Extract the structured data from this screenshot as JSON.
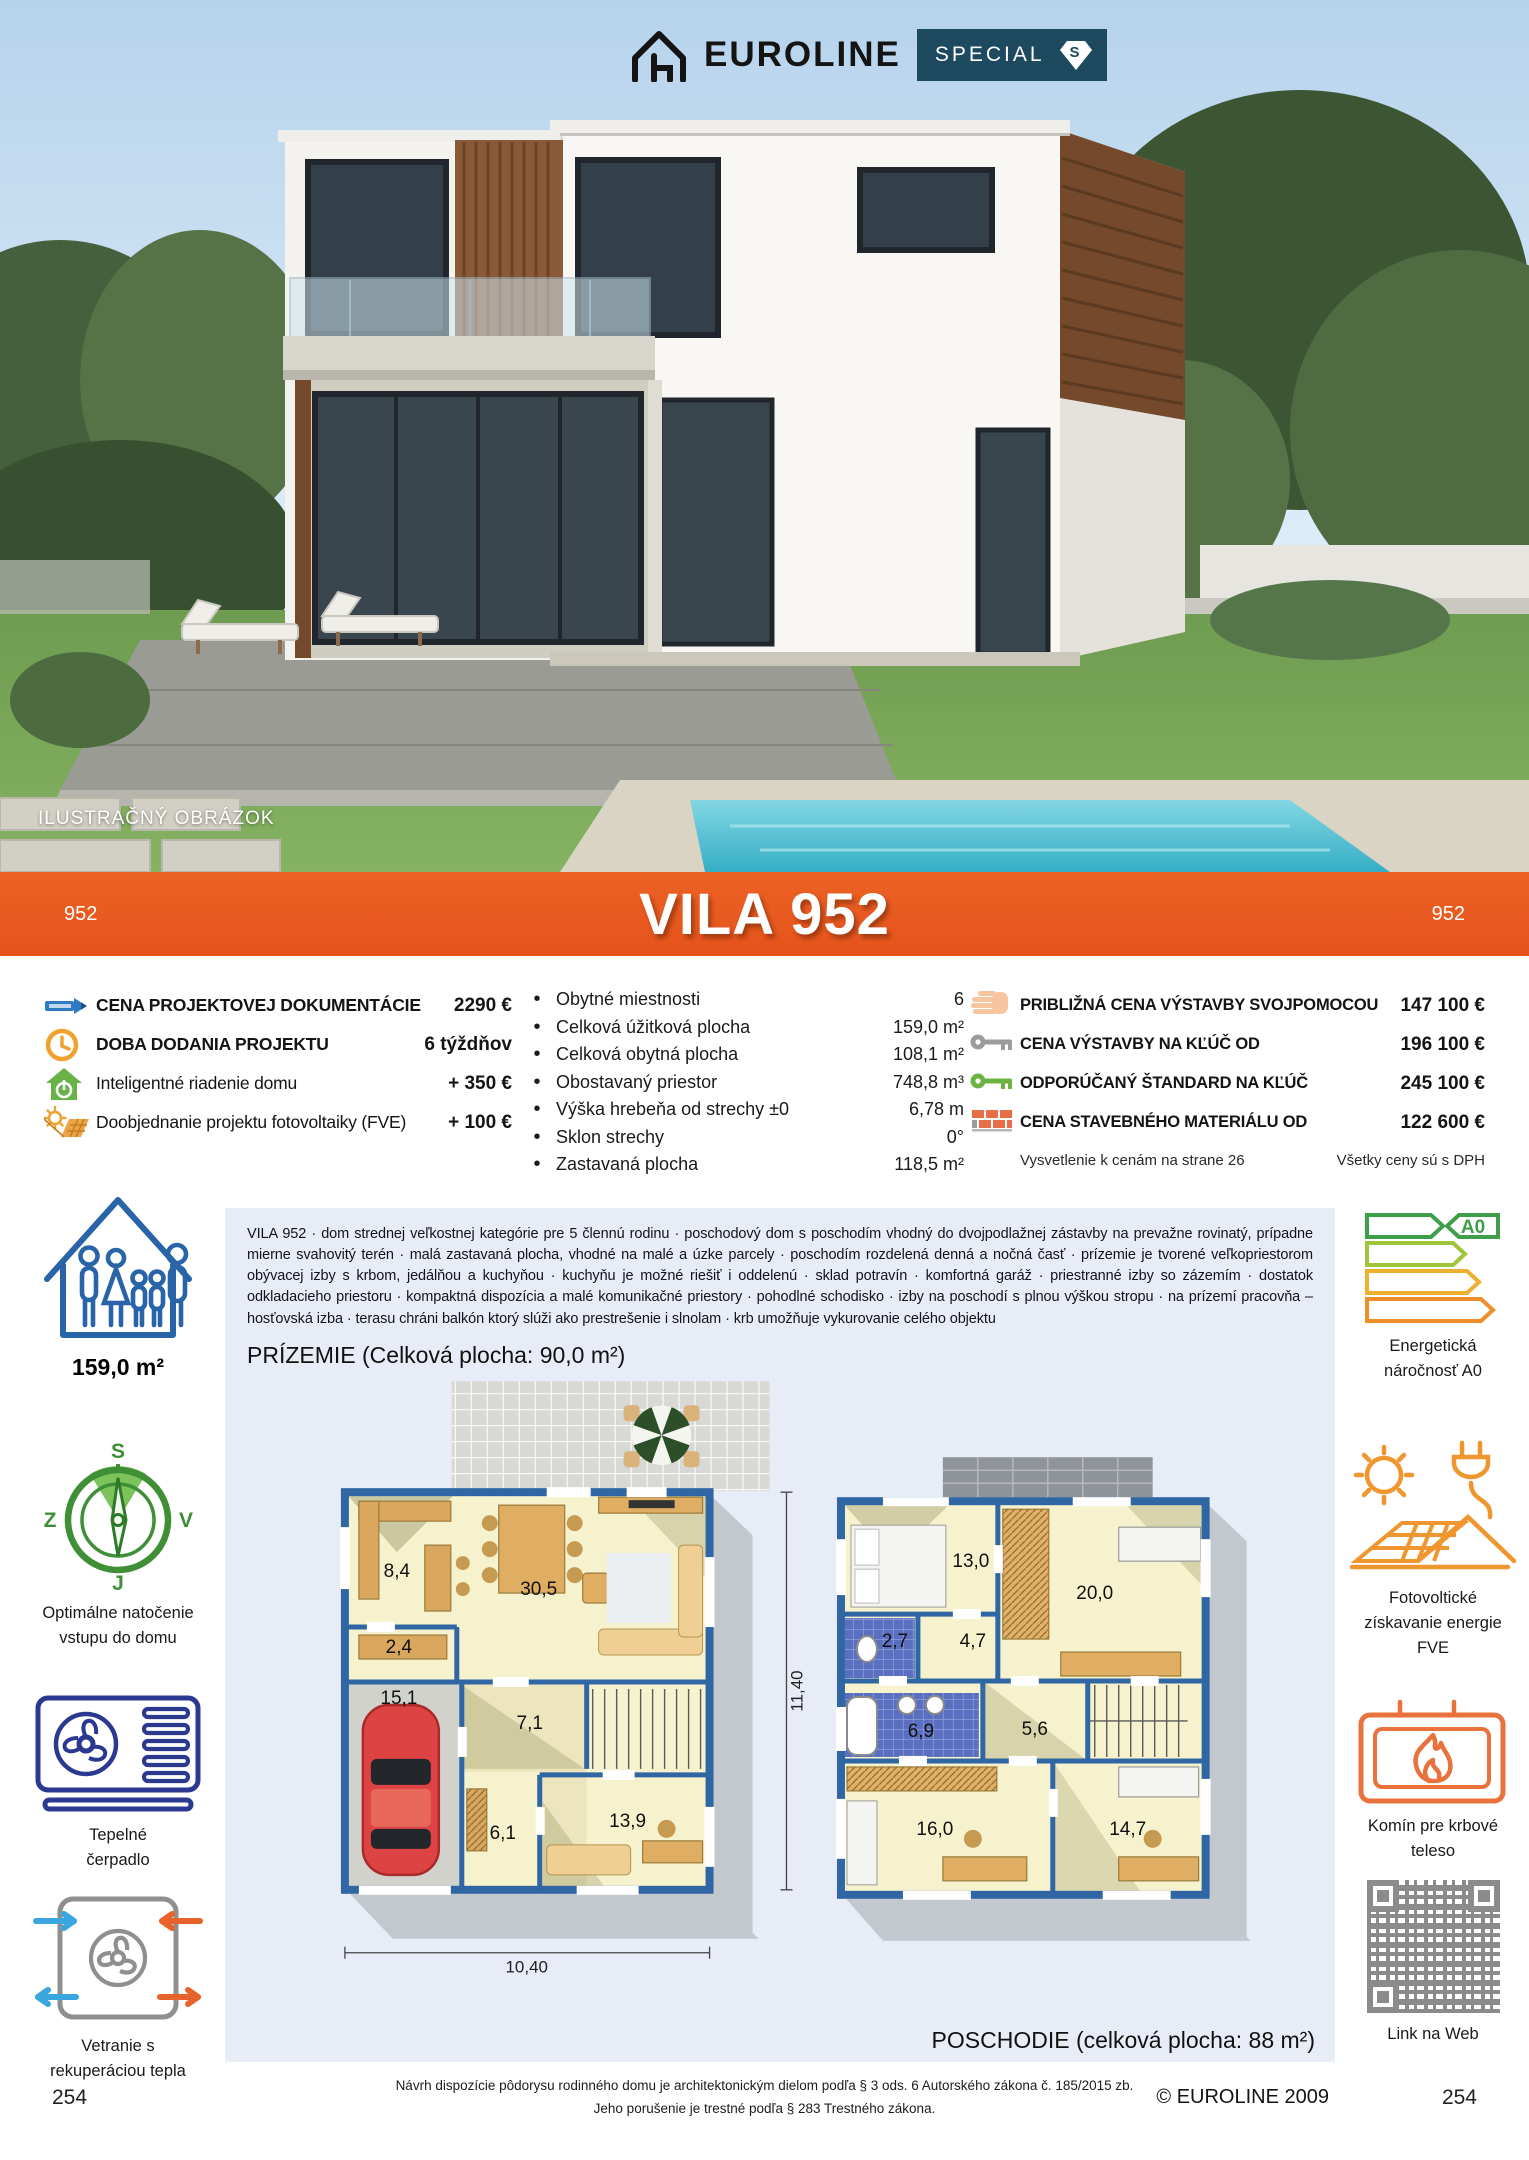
{
  "brand": {
    "name": "EUROLINE",
    "badge": "SPECIAL",
    "badge_letter": "S"
  },
  "photo": {
    "caption": "ILUSTRAČNÝ OBRÁZOK"
  },
  "banner": {
    "code_left": "952",
    "title": "VILA 952",
    "code_right": "952"
  },
  "project_info": [
    {
      "label": "CENA PROJEKTOVEJ DOKUMENTÁCIE",
      "value": "2290 €"
    },
    {
      "label": "DOBA DODANIA PROJEKTU",
      "value": "6 týždňov"
    },
    {
      "label": "Inteligentné riadenie domu",
      "value": "+ 350 €"
    },
    {
      "label": "Doobjednanie projektu fotovoltaiky (FVE)",
      "value": "+ 100 €"
    }
  ],
  "specs": [
    {
      "label": "Obytné miestnosti",
      "value": "6"
    },
    {
      "label": "Celková úžitková plocha",
      "value": "159,0 m²"
    },
    {
      "label": "Celková obytná plocha",
      "value": "108,1 m²"
    },
    {
      "label": "Obostavaný priestor",
      "value": "748,8 m³"
    },
    {
      "label": "Výška hrebeňa od strechy ±0",
      "value": "6,78 m"
    },
    {
      "label": "Sklon strechy",
      "value": "0°"
    },
    {
      "label": "Zastavaná plocha",
      "value": "118,5 m²"
    }
  ],
  "build_prices": [
    {
      "label": "PRIBLIŽNÁ CENA VÝSTAVBY SVOJPOMOCOU",
      "value": "147 100 €"
    },
    {
      "label": "CENA VÝSTAVBY NA KĽÚČ OD",
      "value": "196 100 €"
    },
    {
      "label": "ODPORÚČANÝ ŠTANDARD NA KĽÚČ",
      "value": "245 100 €"
    },
    {
      "label": "CENA STAVEBNÉHO MATERIÁLU OD",
      "value": "122 600 €"
    }
  ],
  "price_notes": {
    "left": "Vysvetlenie k cenám na strane 26",
    "right": "Všetky ceny sú s DPH"
  },
  "left_rail": {
    "area": "159,0 m²",
    "compass": {
      "n": "S",
      "e": "V",
      "s": "J",
      "w": "Z",
      "label1": "Optimálne natočenie",
      "label2": "vstupu do domu"
    },
    "heat_pump": {
      "label1": "Tepelné",
      "label2": "čerpadlo"
    },
    "ventilation": {
      "label1": "Vetranie s",
      "label2": "rekuperáciou tepla"
    }
  },
  "right_rail": {
    "energy": {
      "tag": "A0",
      "label1": "Energetická",
      "label2": "náročnosť A0"
    },
    "pv": {
      "label1": "Fotovoltické",
      "label2": "získavanie energie",
      "label3": "FVE"
    },
    "fireplace": {
      "label1": "Komín pre krbové",
      "label2": "teleso"
    },
    "qr": {
      "label": "Link na Web"
    }
  },
  "description": "VILA 952 · dom strednej veľkostnej kategórie pre 5 člennú rodinu · poschodový dom s poschodím vhodný do dvojpodlažnej zástavby na prevažne rovinatý, prípadne mierne svahovitý terén · malá zastavaná plocha, vhodné na malé a úzke parcely · poschodím rozdelená denná a nočná časť · prízemie je tvorené veľkopriestorom obývacej izby s krbom, jedálňou a kuchyňou · kuchyňu je možné riešiť i oddelenú · sklad potravín · komfortná garáž · priestranné izby so zázemím · dostatok odkladacieho priestoru · kompaktná dispozícia a malé komunikačné priestory · pohodlné schodisko · izby na poschodí s plnou výškou stropu · na prízemí pracovňa – hosťovská izba · terasu chráni balkón ktorý slúži ako prestrešenie i slnolam · krb umožňuje vykurovanie celého objektu",
  "plans": {
    "ground": {
      "heading": "PRÍZEMIE (Celková plocha: 90,0 m²)",
      "rooms": [
        "8,4",
        "30,5",
        "2,4",
        "15,1",
        "7,1",
        "6,1",
        "13,9"
      ],
      "dim_w": "10,40",
      "dim_h": "11,40"
    },
    "upper": {
      "heading": "POSCHODIE (celková plocha: 88 m²)",
      "rooms": [
        "13,0",
        "20,0",
        "2,7",
        "4,7",
        "6,9",
        "5,6",
        "16,0",
        "14,7"
      ]
    }
  },
  "footer": {
    "legal1": "Návrh dispozície pôdorysu rodinného domu je architektonickým dielom podľa § 3 ods. 6 Autorského zákona č. 185/2015 zb.",
    "legal2": "Jeho porušenie je trestné podľa § 283 Trestného zákona.",
    "copyright": "© EUROLINE 2009",
    "page_left": "254",
    "page_right": "254"
  },
  "colors": {
    "accent_orange": "#e5531b",
    "badge_navy": "#1d4a5f",
    "plan_wall_blue": "#2f66a3",
    "panel_blue": "#e7ecf6"
  }
}
